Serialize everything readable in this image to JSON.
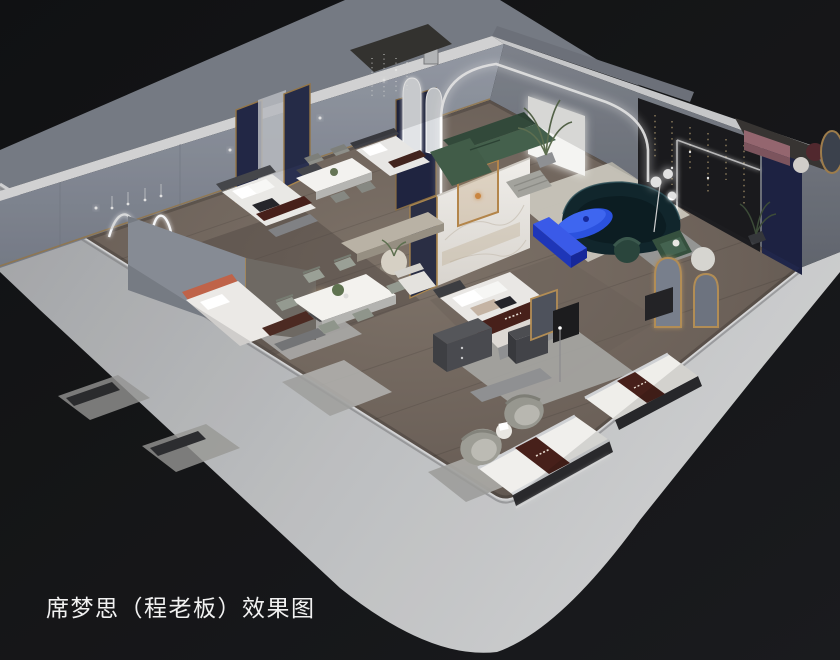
{
  "caption": {
    "text": "席梦思（程老板）效果图",
    "translation": "Simmons (Boss Cheng) rendering",
    "color": "#f1f1f1"
  },
  "scene": {
    "type": "3d-isometric-interior-render",
    "subject": "Cutaway dollhouse-style rendering of a Simmons mattress showroom / apartment on a black studio backdrop",
    "rooms": [
      "bedroom-bay-left",
      "bedroom-bay-middle",
      "master-bedroom",
      "dining-area",
      "living-room",
      "lounge-room",
      "mattress-display-area"
    ],
    "furniture": [
      "bed-with-brand-runner",
      "display-mattress",
      "dining-table-six-chairs",
      "dining-table-four-chairs",
      "green-sectional-sofa",
      "dark-teal-curved-sofa",
      "blue-oval-coffee-table",
      "blue-media-bench",
      "barrel-armchairs",
      "nightstands",
      "arched-floor-mirrors",
      "neon-squiggle-wall-light",
      "crystal-pendant-lights",
      "fairy-light-wall",
      "marble-partition"
    ],
    "palette": {
      "backdrop_black": "#17181a",
      "backdrop_gray": "#858a94",
      "wall_band_light": "#d2d4d7",
      "wall_face_blue_gray": "#939aa6",
      "floor_wood": "#73685f",
      "accent_blue": "#2b52df",
      "sofa_green": "#44604c",
      "sofa_teal_dark": "#11262c",
      "runner_brown": "#47201a",
      "gold_trim": "#a8854e",
      "navy_panel": "#20264a",
      "terracotta": "#bf6349"
    }
  }
}
